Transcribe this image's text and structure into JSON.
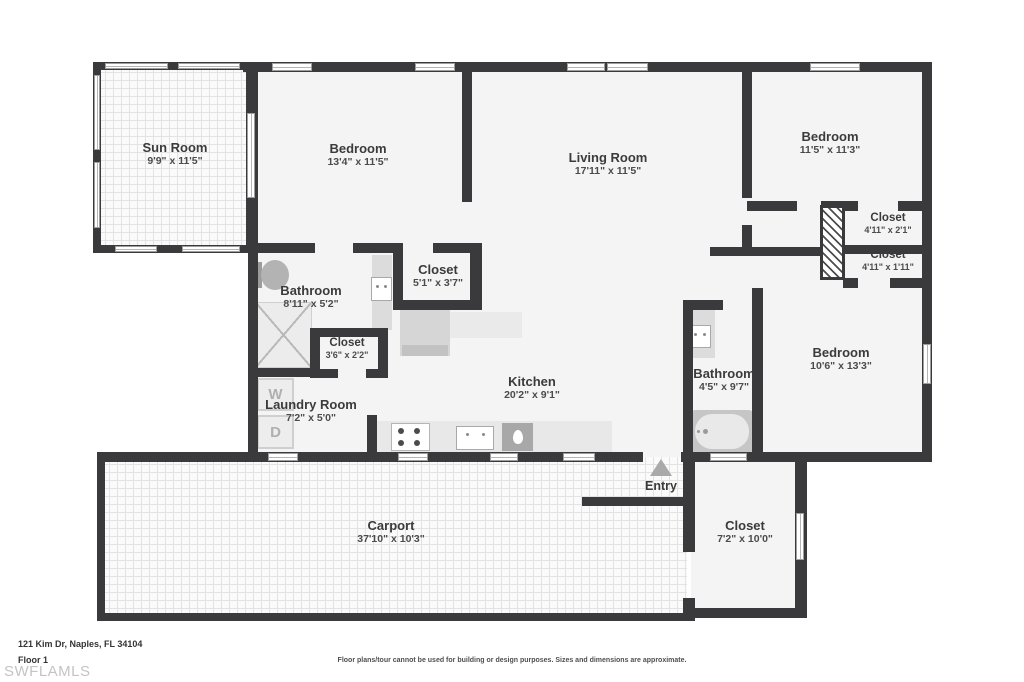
{
  "meta": {
    "address": "121 Kim Dr, Naples, FL 34104",
    "floor_label": "Floor 1",
    "watermark": "SWFLAMLS",
    "disclaimer": "Floor plans/tour cannot be used for building or design purposes. Sizes and dimensions are approximate."
  },
  "rooms": {
    "sun_room": {
      "name": "Sun Room",
      "dims": "9'9\" x 11'5\""
    },
    "bedroom_1": {
      "name": "Bedroom",
      "dims": "13'4\" x 11'5\""
    },
    "living_room": {
      "name": "Living Room",
      "dims": "17'11\" x 11'5\""
    },
    "bedroom_2": {
      "name": "Bedroom",
      "dims": "11'5\" x 11'3\""
    },
    "closet_a": {
      "name": "Closet",
      "dims": "4'11\" x 2'1\""
    },
    "closet_b": {
      "name": "Closet",
      "dims": "4'11\" x 1'11\""
    },
    "bathroom_1": {
      "name": "Bathroom",
      "dims": "8'11\" x 5'2\""
    },
    "closet_c": {
      "name": "Closet",
      "dims": "5'1\" x 3'7\""
    },
    "closet_d": {
      "name": "Closet",
      "dims": "3'6\" x 2'2\""
    },
    "laundry": {
      "name": "Laundry Room",
      "dims": "7'2\" x 5'0\""
    },
    "kitchen": {
      "name": "Kitchen",
      "dims": "20'2\" x 9'1\""
    },
    "bathroom_2": {
      "name": "Bathroom",
      "dims": "4'5\" x 9'7\""
    },
    "bedroom_3": {
      "name": "Bedroom",
      "dims": "10'6\" x 13'3\""
    },
    "entry": {
      "name": "Entry"
    },
    "carport": {
      "name": "Carport",
      "dims": "37'10\" x 10'3\""
    },
    "closet_e": {
      "name": "Closet",
      "dims": "7'2\" x 10'0\""
    }
  },
  "fixtures": {
    "washer": "W",
    "dryer": "D"
  },
  "colors": {
    "wall": "#3a3a3c",
    "room_fill": "#f4f4f4",
    "fixture_gray": "#c6c6c6"
  }
}
